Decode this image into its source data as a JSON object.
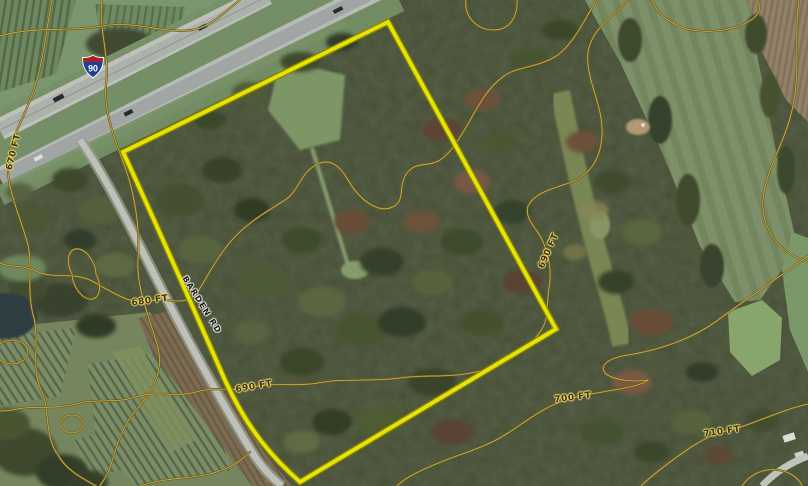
{
  "map": {
    "description": "Aerial parcel map with topographic contour overlay",
    "boundary": {
      "color": "#f2ee00",
      "path": "M 388,22 L 123,152 C 150,210 188,296 224,378 C 248,431 274,459 300,482 L 556,329 Z"
    },
    "contour_color": "#6e5a14",
    "elevations_ft": [
      670,
      680,
      690,
      700,
      710
    ],
    "labels": {
      "contour_670": {
        "text": "670 FT"
      },
      "contour_680": {
        "text": "680 FT"
      },
      "contour_690_west": {
        "text": "690 FT"
      },
      "contour_690_east": {
        "text": "690 FT"
      },
      "contour_700": {
        "text": "700 FT"
      },
      "contour_710": {
        "text": "710 FT"
      },
      "road": {
        "text": "BARDEN RD"
      },
      "highway_route": {
        "text": "90"
      }
    },
    "contours": [
      {
        "name": "contour-670",
        "d": "M 52,0 C 46,30 44,62 32,95 C 22,122 10,140 8,162 C 6,188 20,215 28,245 C 33,268 26,292 34,318 C 40,345 30,368 42,392 C 50,410 44,436 58,455 C 66,470 82,478 96,486"
      },
      {
        "name": "contour-675",
        "d": "M 102,0 C 98,28 110,55 106,85 C 103,112 116,142 126,170 C 135,196 140,228 138,260 C 136,288 150,318 158,348 C 164,372 152,392 136,410 C 122,426 116,448 110,468 C 106,478 102,482 100,486"
      },
      {
        "name": "contour-upper-fields",
        "d": "M 0,36 C 35,26 68,32 102,26 C 136,20 162,34 192,30 C 212,27 226,10 240,0"
      },
      {
        "name": "contour-680",
        "d": "M 596,0 C 584,22 574,42 558,55 C 538,68 518,66 504,76 C 488,87 478,106 468,124 C 459,139 452,152 440,160 C 427,168 414,160 405,176 C 399,188 404,198 396,205 C 382,215 362,204 348,180 C 340,166 330,158 318,164 C 300,172 300,190 285,200 C 268,211 248,222 232,240 C 216,258 206,280 196,294 C 182,308 165,296 150,301 C 132,306 112,292 92,281 C 72,271 54,280 36,271 C 20,264 10,268 0,263"
      },
      {
        "name": "contour-690",
        "d": "M 628,0 C 612,18 592,28 588,52 C 585,80 604,105 602,136 C 600,164 586,178 566,184 C 548,190 534,194 528,206 C 524,220 538,228 544,244 C 549,258 552,272 549,288 C 546,305 550,318 540,332 C 527,350 506,362 486,369 C 458,379 428,374 400,378 C 370,382 342,378 318,383 C 296,387 272,382 254,387 C 234,392 216,386 196,392 C 174,398 156,390 136,397 C 114,404 96,398 76,404 C 52,410 32,405 12,410 C 6,411 2,411 0,411"
      },
      {
        "name": "contour-right-edge",
        "d": "M 799,0 C 794,32 800,66 794,100 C 788,138 770,160 764,192 C 759,218 770,240 790,254 C 796,258 802,260 808,262"
      },
      {
        "name": "contour-700",
        "d": "M 808,256 C 778,278 748,298 718,320 C 694,338 660,350 628,355 C 608,358 598,366 606,374 C 616,381 636,382 648,380 C 640,388 600,391 572,398 C 546,405 528,420 508,433 C 487,447 463,453 441,462 C 421,470 406,477 397,486"
      },
      {
        "name": "contour-710",
        "d": "M 808,404 C 786,409 766,418 744,426 C 736,429 728,430 722,432 C 703,438 688,449 674,459 C 662,468 650,477 641,486"
      },
      {
        "name": "contour-loop-topright",
        "d": "M 652,0 C 657,14 672,26 692,30 C 716,34 744,28 756,16 C 762,9 760,3 756,0"
      },
      {
        "name": "contour-loop-topmid",
        "d": "M 466,0 C 464,16 476,30 494,30 C 510,30 518,16 517,0"
      },
      {
        "name": "contour-arc-bottomright",
        "d": "M 742,486 C 750,474 764,468 778,470 C 792,472 800,480 802,486"
      },
      {
        "name": "contour-bit-bottomleft",
        "d": "M 140,486 C 168,476 198,480 222,470 C 236,465 244,458 250,452"
      },
      {
        "name": "contour-knoll-1",
        "d": "M 72,274 a 12,20 -25 1 0 24,0 a 12,20 -25 1 0 -24,0"
      },
      {
        "name": "contour-knoll-2",
        "d": "M -4,352 a 16,12 0 1 0 32,0 a 16,12 0 1 0 -32,0"
      },
      {
        "name": "contour-knoll-3",
        "d": "M 61,424 a 11,9 0 1 0 22,0 a 11,9 0 1 0 -22,0"
      }
    ]
  }
}
